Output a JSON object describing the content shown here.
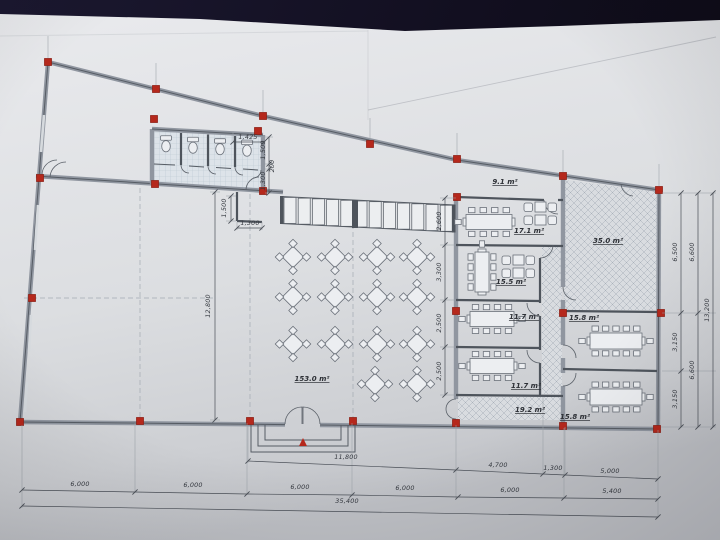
{
  "photo": {
    "subject": "architectural floor plan drawing photographed on paper"
  },
  "rooms": {
    "dining_hall": "153.0 m²",
    "terrace": "9.1 m²",
    "meeting_room": "17.1 m²",
    "lounge": "15.5 m²",
    "office_upper": "11.7 m²",
    "office_lower": "11.7 m²",
    "corridor": "19.2 m²",
    "open_room": "35.0 m²",
    "meeting_right_upper": "15.8 m²",
    "meeting_right_lower": "15.8 m²"
  },
  "dims": {
    "wc_width": "1,425",
    "wc_right": [
      "1,500",
      "200",
      "1,300"
    ],
    "notch_height": "1,500",
    "notch_width": "1,300",
    "hall_height": "12,800",
    "office_col": [
      "2,600",
      "3,300",
      "2,500",
      "2,500"
    ],
    "right_inner": [
      "6,500",
      "3,150",
      "3,150"
    ],
    "right_mid": [
      "6,600",
      "6,600"
    ],
    "right_total": "13,200",
    "bottom_upper": [
      "11,800",
      "4,700",
      "1,300",
      "5,000"
    ],
    "bottom_bays": [
      "6,000",
      "6,000",
      "6,000",
      "6,000",
      "6,000",
      "5,400"
    ],
    "bottom_total": "35,400"
  },
  "icons": {
    "column_marker": "red-square",
    "entrance_marker": "red-triangle",
    "toilet": "wc-fixture"
  },
  "colors": {
    "background": "#141127",
    "paper": "#e4e5e8",
    "paper_shade": "#bfc1c6",
    "wall": "#9096a0",
    "line": "#565c64",
    "column_red": "#b5281c",
    "hatch_line": "#a9b1ba",
    "tile_line": "#bac6d0",
    "dim_text": "#34383f"
  }
}
